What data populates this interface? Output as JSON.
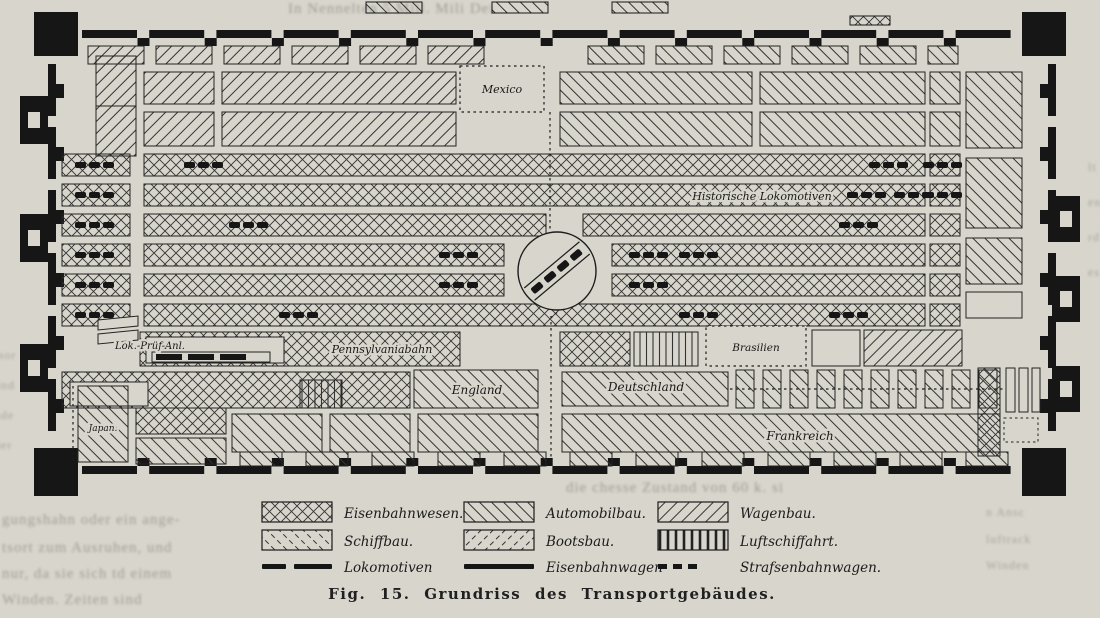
{
  "figure": {
    "caption": "Fig. 15. Grundriss des Transportgebäudes."
  },
  "plan": {
    "labels": {
      "mexico": "Mexico",
      "historische_lokomotiven": "Historische Lokomotiven",
      "lok_pruef_anl": "Lok.-Prüf-Anl.",
      "pennsylvaniabahn": "Pennsylvaniabahn",
      "brasilien": "Brasilien",
      "england": "England",
      "deutschland": "Deutschland",
      "frankreich": "Frankreich",
      "japan": "Japan."
    }
  },
  "legend": {
    "areas": [
      {
        "label": "Eisenbahnwesen.",
        "pattern": "crosshatch"
      },
      {
        "label": "Automobilbau.",
        "pattern": "diagonal-up"
      },
      {
        "label": "Wagenbau.",
        "pattern": "diagonal-down"
      },
      {
        "label": "Schiffbau.",
        "pattern": "diagonal-up-broken"
      },
      {
        "label": "Bootsbau.",
        "pattern": "diagonal-down-broken"
      },
      {
        "label": "Luftschiffahrt.",
        "pattern": "vertical-bars"
      }
    ],
    "lines": [
      {
        "label": "Lokomotiven",
        "style": "dashed"
      },
      {
        "label": "Eisenbahnwagen",
        "style": "solid"
      },
      {
        "label": "Strafsenbahnwagen.",
        "style": "dotted"
      }
    ]
  },
  "ghost_text": {
    "top": "In Nennelten 5 Mill.   Mili Dei",
    "mid": "die chesse Zustand von 60 k. si",
    "bottom_left": [
      "gungshahn oder ein ange-",
      "tsort zum Ausruhen, und",
      "nur, da sie sich td einem",
      "Winden.  Zeiten  sind"
    ],
    "bottom_right": [
      "n Ansc",
      "luftrack",
      "Winden"
    ],
    "left_margin": [
      "mor",
      "und",
      "nde",
      "der"
    ],
    "right_margin": [
      "lt",
      "en",
      "rd",
      "es"
    ]
  },
  "colors": {
    "paper": "#d8d5cc",
    "ink": "#161616"
  }
}
